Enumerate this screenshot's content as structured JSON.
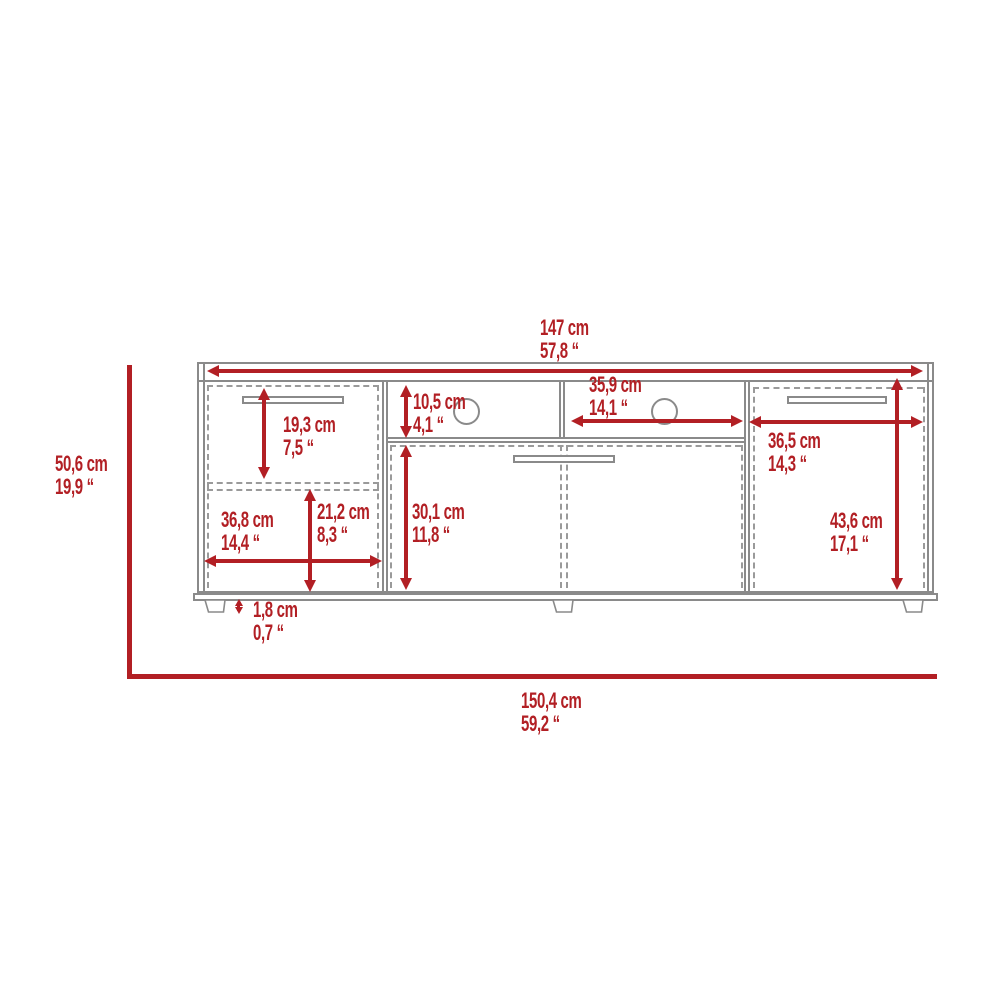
{
  "colors": {
    "dimension_red": "#b21f24",
    "furniture_line_gray": "#8a8a8a"
  },
  "dims": {
    "top_width": {
      "cm": "147 cm",
      "in": "57,8 “"
    },
    "overall_height": {
      "cm": "50,6 cm",
      "in": "19,9 “"
    },
    "overall_width": {
      "cm": "150,4 cm",
      "in": "59,2 “"
    },
    "left_drawer_height": {
      "cm": "19,3 cm",
      "in": "7,5 “"
    },
    "top_shelf_height": {
      "cm": "10,5 cm",
      "in": "4,1 “"
    },
    "middle_shelf_width": {
      "cm": "35,9 cm",
      "in": "14,1 “"
    },
    "right_door_width": {
      "cm": "36,5 cm",
      "in": "14,3 “"
    },
    "middle_door_height": {
      "cm": "30,1 cm",
      "in": "11,8 “"
    },
    "left_door_height": {
      "cm": "21,2 cm",
      "in": "8,3 “"
    },
    "left_door_width": {
      "cm": "36,8 cm",
      "in": "14,4 “"
    },
    "right_door_height": {
      "cm": "43,6 cm",
      "in": "17,1 “"
    },
    "base_height": {
      "cm": "1,8 cm",
      "in": "0,7 “"
    }
  }
}
